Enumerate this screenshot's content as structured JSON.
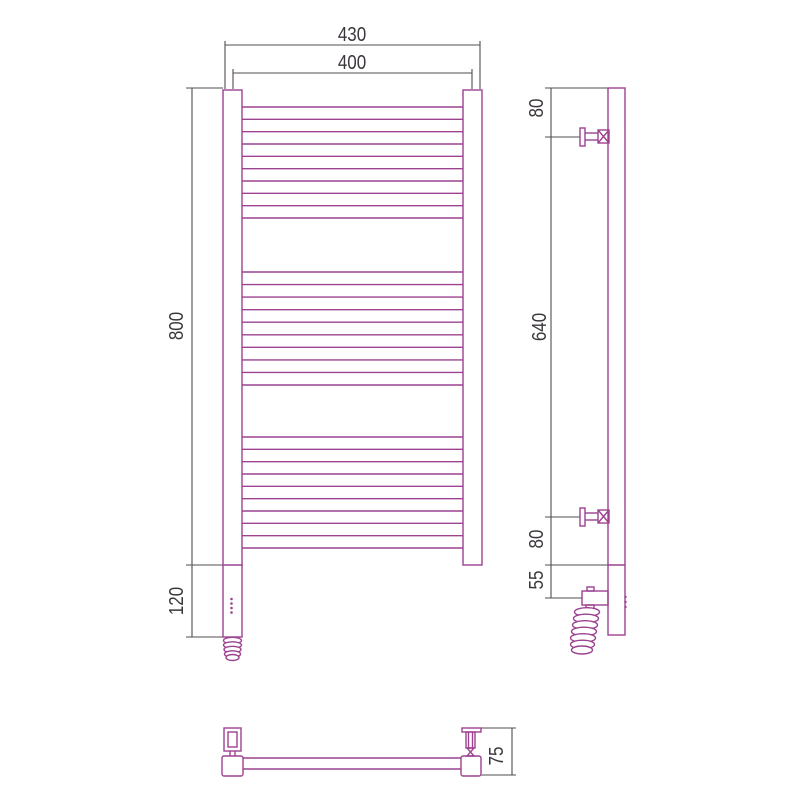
{
  "colors": {
    "product_line": "#9c4290",
    "dimension_line": "#514c50",
    "text": "#3a363b",
    "background": "#ffffff"
  },
  "views": {
    "front": {
      "dimensions": {
        "overall_width": "430",
        "rail_width": "400",
        "overall_height": "800",
        "heater_section_height": "120"
      }
    },
    "side": {
      "dimensions": {
        "top_bracket_offset": "80",
        "bracket_spacing": "640",
        "bottom_bracket_offset": "80",
        "cable_outlet_offset": "55"
      }
    },
    "bottom": {
      "dimensions": {
        "depth": "75"
      }
    }
  },
  "structure": {
    "rung_groups": 3,
    "rungs_per_group": 10
  }
}
